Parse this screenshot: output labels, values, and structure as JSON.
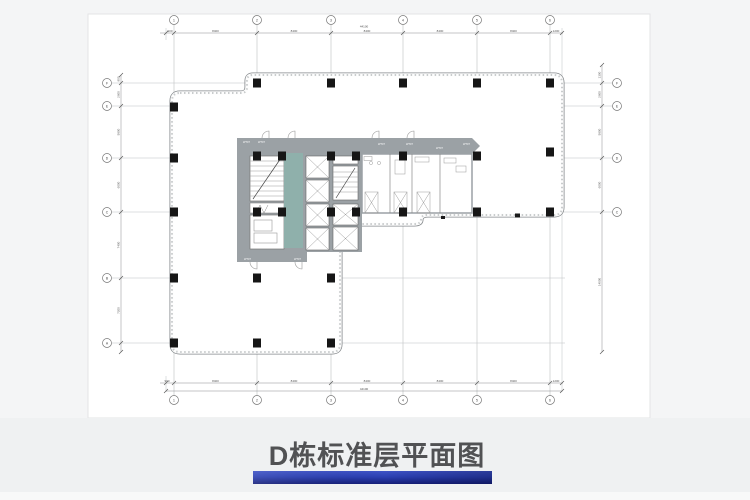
{
  "title_block": {
    "title": "D栋标准层平面图"
  },
  "drawing": {
    "axes": {
      "top": [
        "1",
        "2",
        "3",
        "4",
        "5",
        "6"
      ],
      "bottom": [
        "1",
        "2",
        "3",
        "4",
        "5",
        "6"
      ],
      "left": [
        "F",
        "E",
        "D",
        "C",
        "B",
        "A"
      ],
      "right": [
        "F",
        "E",
        "D",
        "C"
      ]
    },
    "dims": {
      "top": [
        "900",
        "8400",
        "8400",
        "8400",
        "8400",
        "8400",
        "1200"
      ],
      "top_total": "44100",
      "bottom": [
        "900",
        "8400",
        "8400",
        "8400",
        "8400",
        "8400",
        "1200"
      ],
      "bottom_total": "44100",
      "left": [
        "900",
        "2600",
        "5800",
        "6000",
        "7400",
        "7200"
      ],
      "right": [
        "1300",
        "2600",
        "5800",
        "6000",
        "14000"
      ]
    },
    "core_labels": [
      "WT07",
      "WT07",
      "WT07",
      "WT07",
      "WT07",
      "WT07",
      "WT07",
      "WT07"
    ]
  },
  "colors": {
    "core_gray": "#9ba1a5",
    "core_teal": "#8fb0ab",
    "column": "#161616",
    "title_text": "#515254",
    "bar_top": "#3e53c6",
    "bar_mid": "#2c40b2",
    "bar_bottom": "#151f78",
    "page_bg": "#ffffff",
    "band_bg": "#eff1f2"
  }
}
